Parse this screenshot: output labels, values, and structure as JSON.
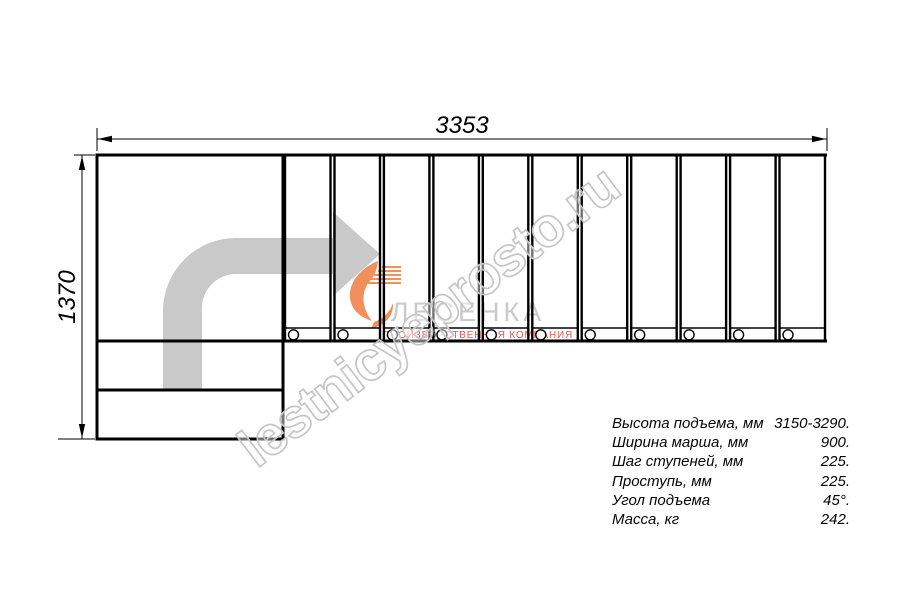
{
  "diagram": {
    "top_dimension_mm": "3353",
    "left_dimension_mm": "1370",
    "steps_count": 11
  },
  "watermark": {
    "text": "lestnicyeprosto.ru"
  },
  "logo": {
    "name": "ЛЕСЕНКА",
    "tagline": "производственная компания"
  },
  "specs": {
    "rows": [
      {
        "label": "Высота подъема, мм",
        "value": "3150-3290."
      },
      {
        "label": "Ширина марша, мм",
        "value": "900."
      },
      {
        "label": "Шаг ступеней, мм",
        "value": "225."
      },
      {
        "label": "Проступь, мм",
        "value": "225."
      },
      {
        "label": "Угол подъема",
        "value": "45°."
      },
      {
        "label": "Масса, кг",
        "value": "242."
      }
    ]
  },
  "colors": {
    "line": "#000000",
    "arrow_gray": "#c9c9c9",
    "watermark_gray": "#c6c6c6",
    "logo_orange": "#f0854c",
    "logo_text_gray": "#c5c5c5",
    "tagline_red": "#e04545"
  }
}
